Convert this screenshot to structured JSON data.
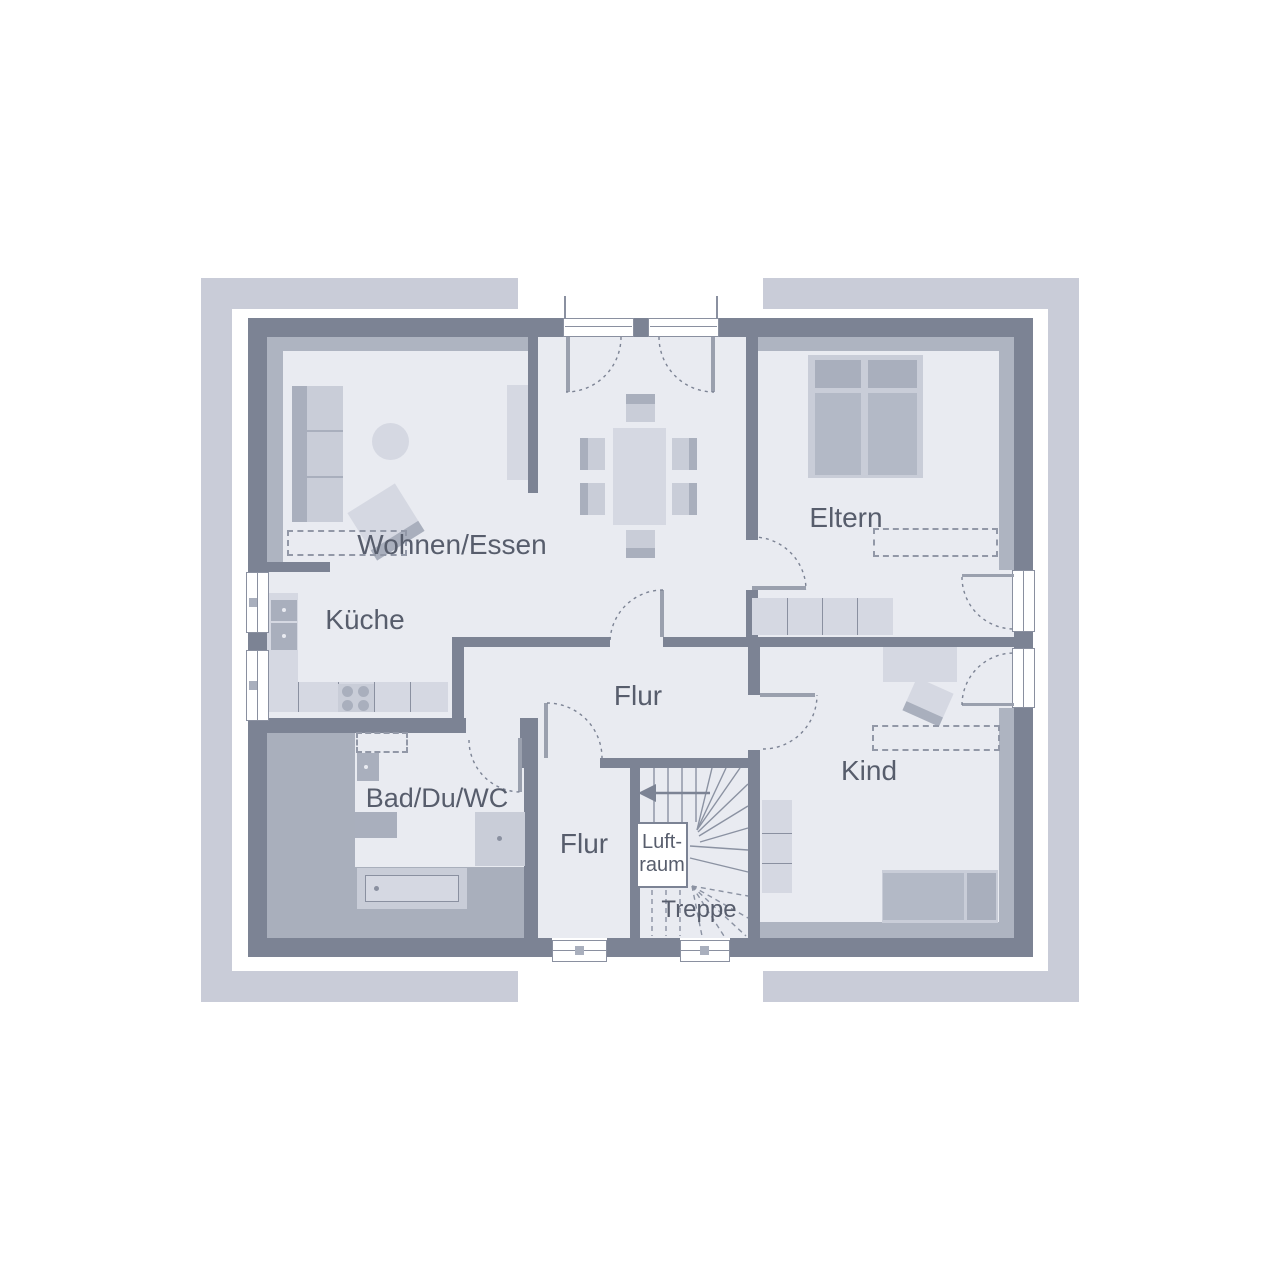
{
  "palette": {
    "white": "#ffffff",
    "frame": "#c9ccd8",
    "wall": "#7c8394",
    "band": "#aeb4c1",
    "bath_zone": "#a9afbc",
    "room": "#e9ebf1",
    "furn_light": "#d5d8e2",
    "furn_mid": "#c9cdd8",
    "furn_dark": "#a9afbd",
    "bed_fill": "#b3b9c6",
    "door_leaf": "#9aa0ae",
    "line": "#8a90a0",
    "dashc": "#9298a7",
    "stair_line": "#8b92a2",
    "text": "#575d6c"
  },
  "rooms": {
    "living": {
      "label": "Wohnen/Essen"
    },
    "kitchen": {
      "label": "Küche"
    },
    "parents": {
      "label": "Eltern"
    },
    "hall_main": {
      "label": "Flur"
    },
    "hall_small": {
      "label": "Flur"
    },
    "bath": {
      "label": "Bad/Du/WC"
    },
    "child": {
      "label": "Kind"
    },
    "stairs": {
      "label": "Treppe"
    },
    "void": {
      "label_line1": "Luft-",
      "label_line2": "raum"
    }
  }
}
